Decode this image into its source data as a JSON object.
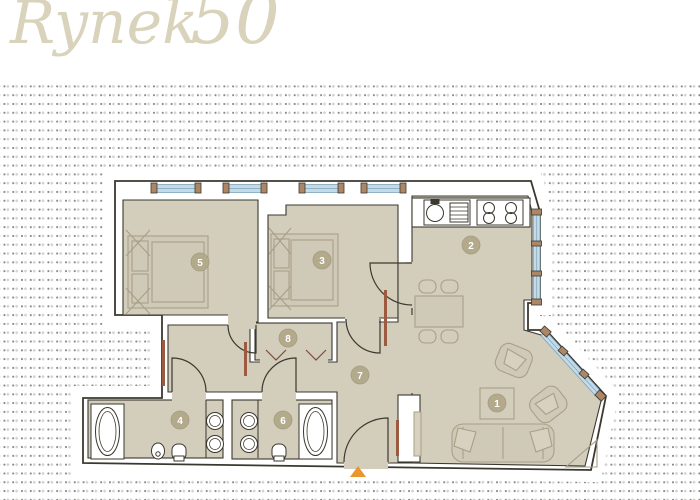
{
  "logo": {
    "city": "WROCŁAW",
    "name": "Rynek",
    "number": "50"
  },
  "plan": {
    "rooms": [
      {
        "number": "1"
      },
      {
        "number": "2"
      },
      {
        "number": "3"
      },
      {
        "number": "4"
      },
      {
        "number": "5"
      },
      {
        "number": "6"
      },
      {
        "number": "7"
      },
      {
        "number": "8"
      }
    ]
  },
  "colors": {
    "floor": "#d3cdbc",
    "wall_line": "#3b382f",
    "furniture_line": "#a89f86",
    "badge": "#b3aa8c",
    "window_glass": "#c3dbe8",
    "window_frame": "#ad8765",
    "radiator": "#9c5a41",
    "entrance_marker": "#e8962e",
    "logo": "#d9d3bc",
    "dot_dark": "#85858a",
    "dot_light": "#d2d2cf"
  }
}
